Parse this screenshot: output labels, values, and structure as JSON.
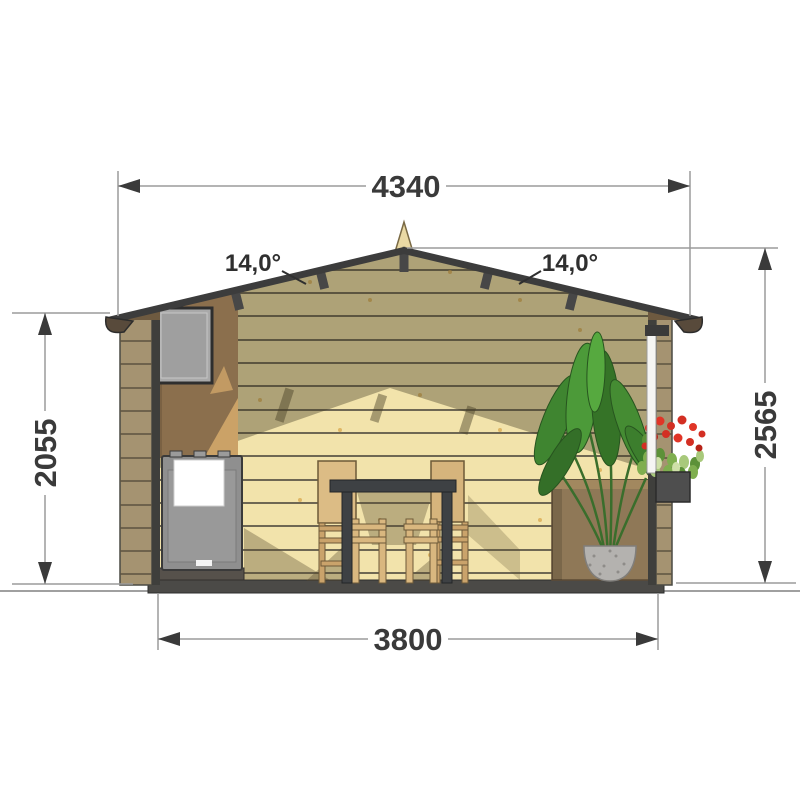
{
  "document": {
    "type": "architectural cross-section drawing",
    "subject": "log garden cabin / sauna sectional elevation"
  },
  "dimensions": {
    "overall_width": "4340",
    "base_width": "3800",
    "eaves_height": "2055",
    "ridge_height": "2565",
    "roof_angle_left": "14,0°",
    "roof_angle_right": "14,0°"
  },
  "colors": {
    "background": "#ffffff",
    "dimension_lines": "#9b9b9b",
    "dimension_text": "#3a3a3a",
    "roof_edge": "#3c3c3c",
    "wall_wood_light": "#f2e3ab",
    "wall_wood_shadow": "#aca077",
    "log_section_wood": "#a59371",
    "partition_wood": "#8b6f4d",
    "stove_gray": "#8f8f8f",
    "towel_white": "#ffffff",
    "plant_green": "#3f8530",
    "flower_red": "#d32f23",
    "floor_slab": "#4b4a47"
  }
}
